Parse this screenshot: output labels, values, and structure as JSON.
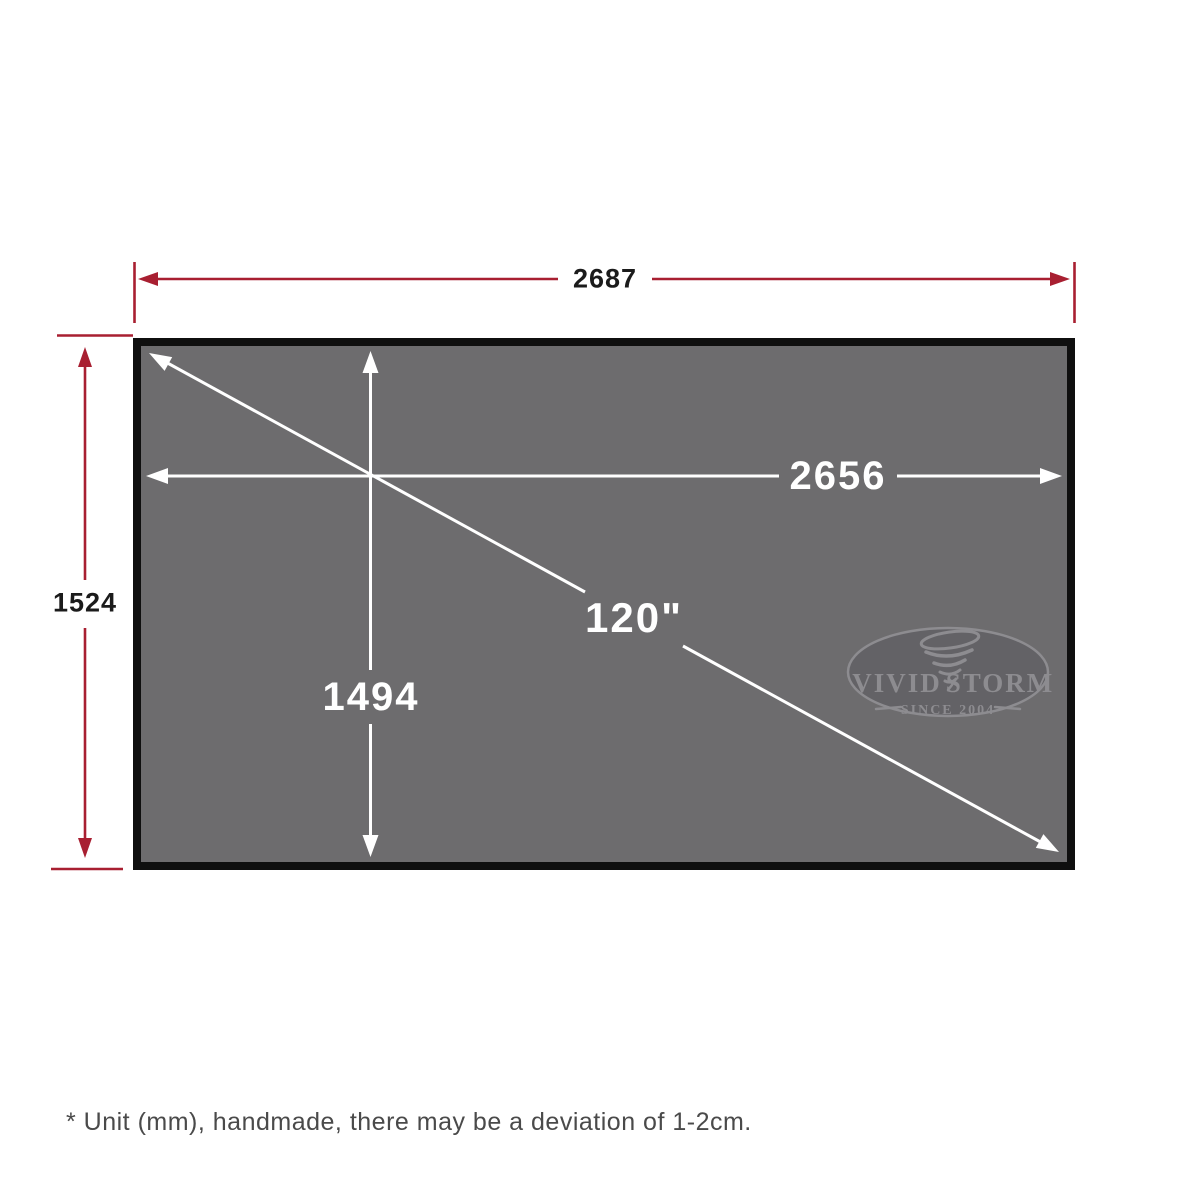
{
  "colors": {
    "dimension_red": "#a81f31",
    "screen_gray": "#6d6c6e",
    "border_black": "#0f0f0f",
    "arrow_white": "#ffffff",
    "label_black": "#1b1b1b",
    "note_gray": "#4a4a4a",
    "logo_fill": "#636266",
    "logo_line": "#8d8c90"
  },
  "dimensions": {
    "outer_width": "2687",
    "outer_height": "1524",
    "viewing_width": "2656",
    "viewing_height": "1494",
    "diagonal": "120\""
  },
  "logo": {
    "brand_left": "VIVID",
    "brand_right": "STORM",
    "tagline": "SINCE 2004"
  },
  "footnote": "* Unit (mm), handmade, there may be a deviation of 1-2cm."
}
